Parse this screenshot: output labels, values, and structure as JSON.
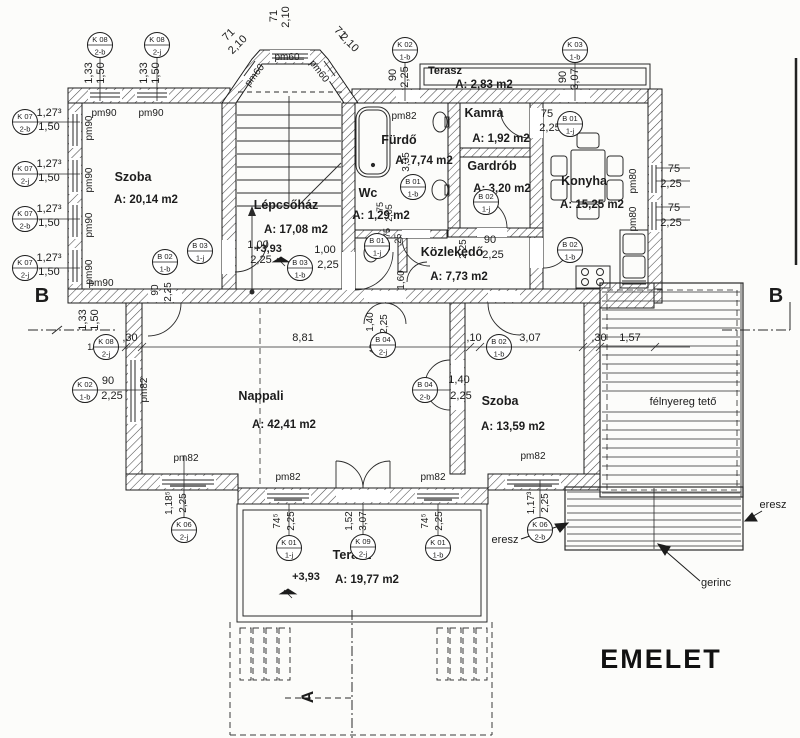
{
  "title": "EMELET",
  "colors": {
    "ink": "#1c1c1c",
    "paper": "#fcfcfa"
  },
  "rooms": [
    {
      "name": "Szoba",
      "area": "A: 20,14 m2",
      "nx": 133,
      "ny": 181,
      "ax": 146,
      "ay": 203
    },
    {
      "name": "Lépcsőház",
      "area": "A: 17,08 m2",
      "nx": 286,
      "ny": 209,
      "ax": 296,
      "ay": 233
    },
    {
      "name": "Fürdő",
      "area": "A: 7,74 m2",
      "nx": 399,
      "ny": 144,
      "ax": 424,
      "ay": 164
    },
    {
      "name": "Wc",
      "area": "A: 1,29 m2",
      "nx": 368,
      "ny": 197,
      "ax": 381,
      "ay": 219
    },
    {
      "name": "Kamra",
      "area": "A: 1,92 m2",
      "nx": 484,
      "ny": 117,
      "ax": 501,
      "ay": 142
    },
    {
      "name": "Gardrób",
      "area": "A: 3,20 m2",
      "nx": 492,
      "ny": 170,
      "ax": 502,
      "ay": 192
    },
    {
      "name": "Konyha",
      "area": "A: 15,25 m2",
      "nx": 584,
      "ny": 185,
      "ax": 592,
      "ay": 208
    },
    {
      "name": "Közlekedő",
      "area": "A: 7,73 m2",
      "nx": 452,
      "ny": 256,
      "ax": 459,
      "ay": 280
    },
    {
      "name": "Nappali",
      "area": "A: 42,41 m2",
      "nx": 261,
      "ny": 400,
      "ax": 284,
      "ay": 428
    },
    {
      "name": "Szoba",
      "area": "A: 13,59 m2",
      "nx": 500,
      "ny": 405,
      "ax": 513,
      "ay": 430
    },
    {
      "name": "Terasz",
      "area": "A: 2,83 m2",
      "nx": 445,
      "ny": 74,
      "ax": 484,
      "ay": 88,
      "ns": 11
    },
    {
      "name": "Terasz",
      "area": "A: 19,77 m2",
      "nx": 352,
      "ny": 559,
      "ax": 367,
      "ay": 583
    },
    {
      "name": "félnyereg tető",
      "area": "",
      "nx": 683,
      "ny": 405,
      "w": "normal",
      "ns": 11
    }
  ],
  "markers": [
    {
      "c": "K 08",
      "s": "2-b",
      "x": 100,
      "y": 45
    },
    {
      "c": "K 08",
      "s": "2-j",
      "x": 157,
      "y": 45
    },
    {
      "c": "K 02",
      "s": "1-b",
      "x": 405,
      "y": 50
    },
    {
      "c": "K 03",
      "s": "1-b",
      "x": 575,
      "y": 50
    },
    {
      "c": "K 07",
      "s": "2-b",
      "x": 25,
      "y": 122
    },
    {
      "c": "K 07",
      "s": "2-j",
      "x": 25,
      "y": 174
    },
    {
      "c": "K 07",
      "s": "2-b",
      "x": 25,
      "y": 219
    },
    {
      "c": "K 07",
      "s": "2-j",
      "x": 25,
      "y": 268
    },
    {
      "c": "B 02",
      "s": "1-b",
      "x": 165,
      "y": 262
    },
    {
      "c": "B 03",
      "s": "1-j",
      "x": 200,
      "y": 251
    },
    {
      "c": "B 03",
      "s": "1-b",
      "x": 300,
      "y": 268
    },
    {
      "c": "B 01",
      "s": "1-b",
      "x": 413,
      "y": 187
    },
    {
      "c": "B 01",
      "s": "1-j",
      "x": 377,
      "y": 246
    },
    {
      "c": "B 02",
      "s": "1-j",
      "x": 486,
      "y": 202
    },
    {
      "c": "B 01",
      "s": "1-j",
      "x": 570,
      "y": 124
    },
    {
      "c": "B 02",
      "s": "1-b",
      "x": 570,
      "y": 250
    },
    {
      "c": "B 02",
      "s": "1-b",
      "x": 499,
      "y": 347
    },
    {
      "c": "B 04",
      "s": "2-j",
      "x": 383,
      "y": 345
    },
    {
      "c": "B 04",
      "s": "2-b",
      "x": 425,
      "y": 390
    },
    {
      "c": "K 02",
      "s": "1-b",
      "x": 85,
      "y": 390
    },
    {
      "c": "K 08",
      "s": "2-j",
      "x": 106,
      "y": 347
    },
    {
      "c": "K 06",
      "s": "2-j",
      "x": 184,
      "y": 530
    },
    {
      "c": "K 06",
      "s": "2-b",
      "x": 540,
      "y": 530
    },
    {
      "c": "K 01",
      "s": "1-j",
      "x": 289,
      "y": 548
    },
    {
      "c": "K 09",
      "s": "2-j",
      "x": 363,
      "y": 547
    },
    {
      "c": "K 01",
      "s": "1-b",
      "x": 438,
      "y": 548
    }
  ],
  "labels": [
    {
      "t": "71",
      "x": 277,
      "y": 16,
      "r": -90
    },
    {
      "t": "2,10",
      "x": 289,
      "y": 17,
      "r": -90
    },
    {
      "t": "71",
      "x": 231,
      "y": 37,
      "r": -45
    },
    {
      "t": "2,10",
      "x": 240,
      "y": 47,
      "r": -45
    },
    {
      "t": "71",
      "x": 338,
      "y": 35,
      "r": 45
    },
    {
      "t": "2,10",
      "x": 347,
      "y": 45,
      "r": 45
    },
    {
      "t": "pm60",
      "x": 287,
      "y": 60,
      "s": 10
    },
    {
      "t": "pm60",
      "x": 257,
      "y": 77,
      "r": -52,
      "s": 10
    },
    {
      "t": "pm60",
      "x": 317,
      "y": 73,
      "r": 52,
      "s": 10
    },
    {
      "t": "1,33",
      "x": 92,
      "y": 73,
      "r": -90
    },
    {
      "t": "1,50",
      "x": 104,
      "y": 73,
      "r": -90
    },
    {
      "t": "1,33",
      "x": 147,
      "y": 73,
      "r": -90
    },
    {
      "t": "1,50",
      "x": 159,
      "y": 73,
      "r": -90
    },
    {
      "t": "pm90",
      "x": 104,
      "y": 116,
      "s": 10
    },
    {
      "t": "pm90",
      "x": 151,
      "y": 116,
      "s": 10
    },
    {
      "t": "90",
      "x": 396,
      "y": 75,
      "r": -90
    },
    {
      "t": "2,25",
      "x": 408,
      "y": 77,
      "r": -90
    },
    {
      "t": "90",
      "x": 566,
      "y": 77,
      "r": -90
    },
    {
      "t": "3,07",
      "x": 578,
      "y": 79,
      "r": -90
    },
    {
      "t": "1,27³",
      "x": 49,
      "y": 116
    },
    {
      "t": "1,50",
      "x": 49,
      "y": 130
    },
    {
      "t": "1,27³",
      "x": 49,
      "y": 167
    },
    {
      "t": "1,50",
      "x": 49,
      "y": 181
    },
    {
      "t": "1,27³",
      "x": 49,
      "y": 212
    },
    {
      "t": "1,50",
      "x": 49,
      "y": 226
    },
    {
      "t": "1,27³",
      "x": 49,
      "y": 261
    },
    {
      "t": "1,50",
      "x": 49,
      "y": 275
    },
    {
      "t": "pm90",
      "x": 92,
      "y": 128,
      "r": -90,
      "s": 10
    },
    {
      "t": "pm90",
      "x": 92,
      "y": 180,
      "r": -90,
      "s": 10
    },
    {
      "t": "pm90",
      "x": 92,
      "y": 225,
      "r": -90,
      "s": 10
    },
    {
      "t": "pm90",
      "x": 92,
      "y": 272,
      "r": -90,
      "s": 10
    },
    {
      "t": "pm90",
      "x": 101,
      "y": 286,
      "s": 10
    },
    {
      "t": "1,33",
      "x": 86,
      "y": 320,
      "r": -90
    },
    {
      "t": "1,50",
      "x": 98,
      "y": 320,
      "r": -90
    },
    {
      "t": "1/",
      "x": 91,
      "y": 350,
      "s": 9
    },
    {
      "t": "90",
      "x": 158,
      "y": 290,
      "r": -90,
      "s": 10
    },
    {
      "t": "2,25",
      "x": 171,
      "y": 292,
      "r": -90,
      "s": 10
    },
    {
      "t": ",30",
      "x": 130,
      "y": 341
    },
    {
      "t": "8,81",
      "x": 303,
      "y": 341
    },
    {
      "t": ",10",
      "x": 474,
      "y": 341
    },
    {
      "t": "3,07",
      "x": 530,
      "y": 341
    },
    {
      "t": ",30",
      "x": 599,
      "y": 341
    },
    {
      "t": "1,57",
      "x": 630,
      "y": 341
    },
    {
      "t": "90",
      "x": 108,
      "y": 384
    },
    {
      "t": "2,25",
      "x": 112,
      "y": 399
    },
    {
      "t": "pm82",
      "x": 147,
      "y": 390,
      "r": -90,
      "s": 10
    },
    {
      "t": "+3,93",
      "x": 268,
      "y": 252,
      "w": "bold"
    },
    {
      "t": "1,00",
      "x": 258,
      "y": 248
    },
    {
      "t": "2,25",
      "x": 261,
      "y": 263
    },
    {
      "t": "1,00",
      "x": 325,
      "y": 253
    },
    {
      "t": "2,25",
      "x": 328,
      "y": 268
    },
    {
      "t": "pm82",
      "x": 404,
      "y": 119,
      "s": 10
    },
    {
      "t": "3,35",
      "x": 409,
      "y": 162,
      "r": -90,
      "s": 10
    },
    {
      "t": "75",
      "x": 383,
      "y": 207,
      "r": -90,
      "s": 9
    },
    {
      "t": "2,05",
      "x": 392,
      "y": 213,
      "r": -90,
      "s": 9
    },
    {
      "t": "75",
      "x": 390,
      "y": 233,
      "r": -90,
      "s": 9
    },
    {
      "t": "10",
      "x": 390,
      "y": 246,
      "r": -90,
      "s": 9
    },
    {
      "t": ",25",
      "x": 401,
      "y": 240,
      "r": -90,
      "s": 9
    },
    {
      "t": "1,60",
      "x": 404,
      "y": 280,
      "r": -90,
      "s": 10
    },
    {
      "t": "1,40",
      "x": 373,
      "y": 322,
      "r": -90,
      "s": 10
    },
    {
      "t": "2,25",
      "x": 387,
      "y": 324,
      "r": -90,
      "s": 10
    },
    {
      "t": "45",
      "x": 376,
      "y": 349,
      "r": -90,
      "s": 9
    },
    {
      "t": "75",
      "x": 547,
      "y": 117
    },
    {
      "t": "2,25",
      "x": 550,
      "y": 131
    },
    {
      "t": "2,25",
      "x": 466,
      "y": 249,
      "r": -90,
      "s": 10
    },
    {
      "t": "90",
      "x": 490,
      "y": 243
    },
    {
      "t": "2,25",
      "x": 493,
      "y": 258
    },
    {
      "t": "pm80",
      "x": 636,
      "y": 181,
      "r": -90,
      "s": 10
    },
    {
      "t": "75",
      "x": 674,
      "y": 172
    },
    {
      "t": "2,25",
      "x": 671,
      "y": 187
    },
    {
      "t": "pm80",
      "x": 636,
      "y": 219,
      "r": -90,
      "s": 10
    },
    {
      "t": "75",
      "x": 674,
      "y": 211
    },
    {
      "t": "2,25",
      "x": 671,
      "y": 226
    },
    {
      "t": "1,40",
      "x": 459,
      "y": 383
    },
    {
      "t": "2,25",
      "x": 461,
      "y": 399
    },
    {
      "t": "pm82",
      "x": 186,
      "y": 461,
      "s": 10
    },
    {
      "t": "1,18⁵",
      "x": 172,
      "y": 503,
      "r": -90,
      "s": 10
    },
    {
      "t": "2,25",
      "x": 186,
      "y": 503,
      "r": -90,
      "s": 10
    },
    {
      "t": "pm82",
      "x": 288,
      "y": 480,
      "s": 10
    },
    {
      "t": "pm82",
      "x": 433,
      "y": 480,
      "s": 10
    },
    {
      "t": "pm82",
      "x": 533,
      "y": 459,
      "s": 10
    },
    {
      "t": "74⁵",
      "x": 280,
      "y": 521,
      "r": -90,
      "s": 10
    },
    {
      "t": "2,25",
      "x": 294,
      "y": 521,
      "r": -90,
      "s": 10
    },
    {
      "t": "1,52",
      "x": 352,
      "y": 521,
      "r": -90,
      "s": 10
    },
    {
      "t": "3,07",
      "x": 366,
      "y": 521,
      "r": -90,
      "s": 10
    },
    {
      "t": "74⁵",
      "x": 428,
      "y": 521,
      "r": -90,
      "s": 10
    },
    {
      "t": "2,25",
      "x": 442,
      "y": 521,
      "r": -90,
      "s": 10
    },
    {
      "t": "+3,93",
      "x": 306,
      "y": 580,
      "w": "bold"
    },
    {
      "t": "1,17³",
      "x": 534,
      "y": 503,
      "r": -90,
      "s": 10
    },
    {
      "t": "2,25",
      "x": 548,
      "y": 503,
      "r": -90,
      "s": 10
    },
    {
      "t": "eresz",
      "x": 505,
      "y": 543
    },
    {
      "t": "eresz",
      "x": 773,
      "y": 508
    },
    {
      "t": "gerinc",
      "x": 716,
      "y": 586
    },
    {
      "t": "B",
      "x": 42,
      "y": 302,
      "s": 20,
      "w": "bold"
    },
    {
      "t": "B",
      "x": 776,
      "y": 302,
      "s": 20,
      "w": "bold"
    },
    {
      "t": "A",
      "x": 313,
      "y": 697,
      "s": 17,
      "w": "bold",
      "r": -90
    }
  ]
}
